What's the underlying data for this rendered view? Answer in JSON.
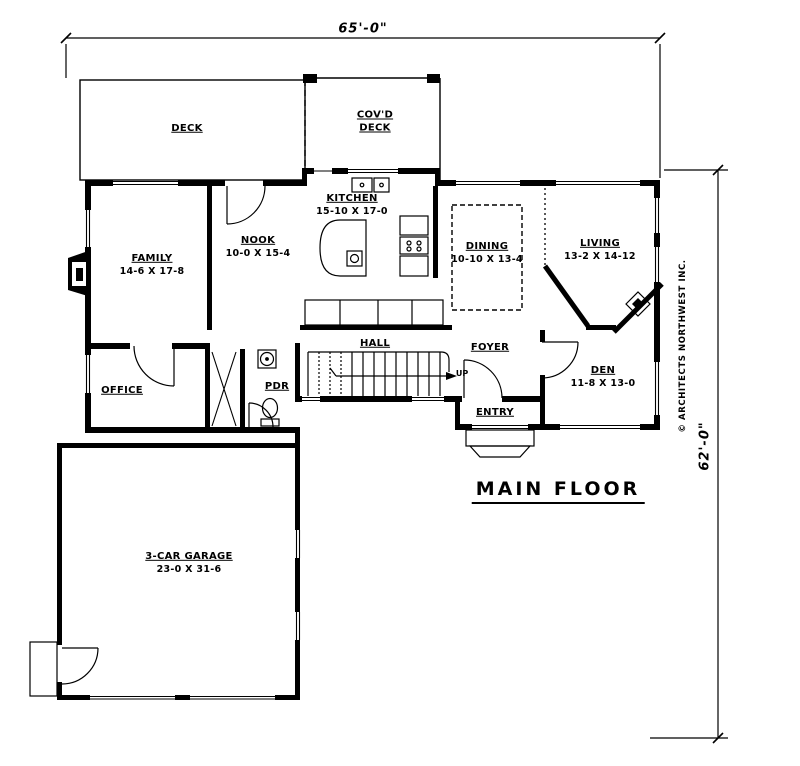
{
  "title": {
    "text": "MAIN FLOOR"
  },
  "dimensions": {
    "top": "65'-0\"",
    "right": "62'-0\""
  },
  "copyright": {
    "text": "© ARCHITECTS NORTHWEST INC."
  },
  "colors": {
    "ink": "#000000",
    "paper": "#ffffff"
  },
  "rooms": {
    "deck": {
      "name": "DECK"
    },
    "covd_deck": {
      "line1": "COV'D",
      "line2": "DECK"
    },
    "kitchen": {
      "name": "KITCHEN",
      "size": "15-10 X 17-0"
    },
    "nook": {
      "name": "NOOK",
      "size": "10-0 X 15-4"
    },
    "family": {
      "name": "FAMILY",
      "size": "14-6 X 17-8"
    },
    "dining": {
      "name": "DINING",
      "size": "10-10 X 13-4"
    },
    "living": {
      "name": "LIVING",
      "size": "13-2 X 14-12"
    },
    "office": {
      "name": "OFFICE"
    },
    "pdr": {
      "name": "PDR"
    },
    "hall": {
      "name": "HALL"
    },
    "foyer": {
      "name": "FOYER"
    },
    "entry": {
      "name": "ENTRY"
    },
    "den": {
      "name": "DEN",
      "size": "11-8 X 13-0"
    },
    "garage": {
      "name": "3-CAR GARAGE",
      "size": "23-0 X 31-6"
    },
    "stairs": {
      "direction": "UP"
    }
  }
}
